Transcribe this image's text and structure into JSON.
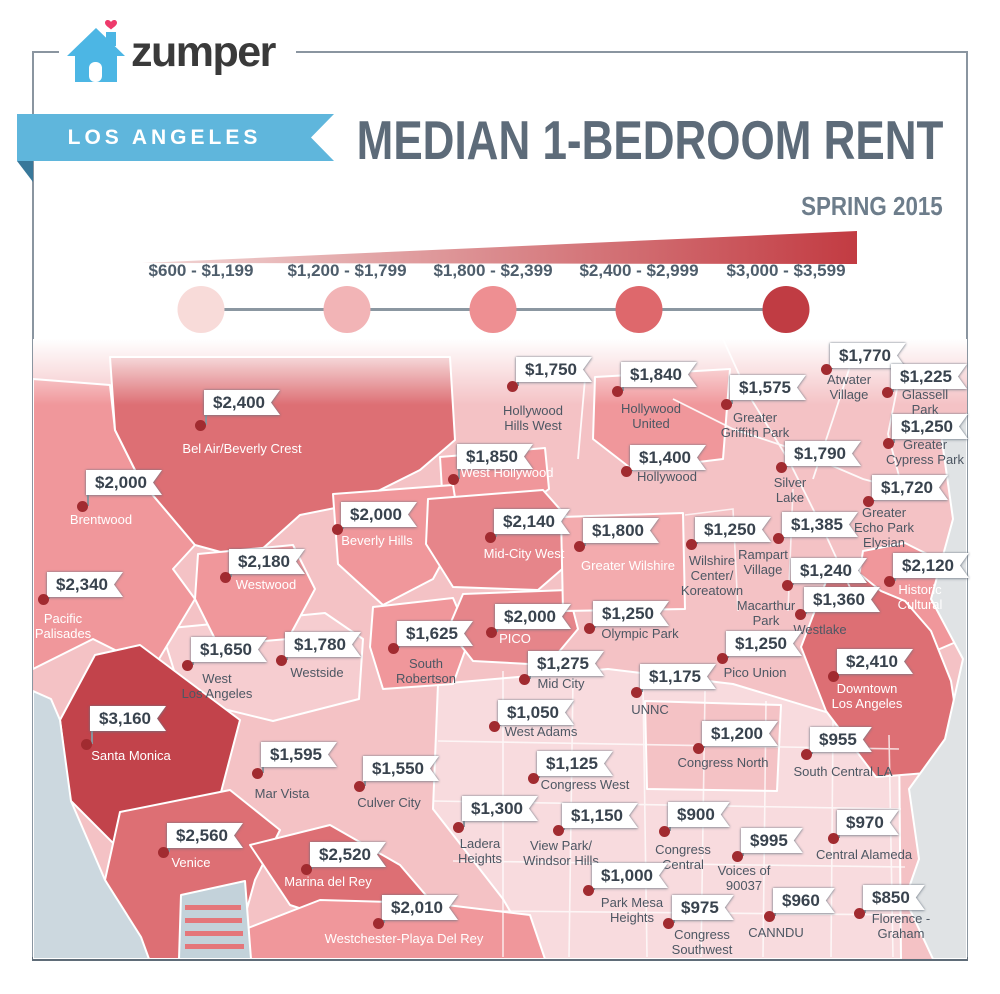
{
  "header": {
    "brand": "zumper",
    "ribbon": "LOS ANGELES",
    "title": "MEDIAN 1-BEDROOM RENT",
    "subtitle": "SPRING 2015"
  },
  "colors": {
    "ribbon_blue": "#5fb6dc",
    "ribbon_fold": "#38789a",
    "title": "#5d6b79",
    "subtitle": "#6d7d8b",
    "brand_text": "#3a3a3a",
    "house_blue": "#4cb6e4",
    "heart_pink": "#ee3a6b",
    "frame": "#8a95a0",
    "frame_bottom": "#5f6c78",
    "flag_text": "#39434e",
    "label_dark": "#4d5763",
    "label_light": "#ffffff",
    "dot": "#a12b30",
    "pole": "#8a939c",
    "legend_label": "#4e5d6b",
    "legend_line": "#8b97a1"
  },
  "legend": {
    "wedge": {
      "from": "#f2d8d7",
      "to": "#c23b42"
    },
    "ranges": [
      {
        "label": "$600 - $1,199",
        "color": "#f8dbd9",
        "x": 201
      },
      {
        "label": "$1,200 - $1,799",
        "color": "#f2b4b6",
        "x": 347
      },
      {
        "label": "$1,800 - $2,399",
        "color": "#ee8f92",
        "x": 493
      },
      {
        "label": "$2,400 - $2,999",
        "color": "#de686c",
        "x": 639
      },
      {
        "label": "$3,000 - $3,599",
        "color": "#c03c43",
        "x": 786
      }
    ]
  },
  "map": {
    "bucket_colors": {
      "b1": "#f8dbde",
      "b2": "#f4c2c5",
      "b2l": "#f6cdd0",
      "b3": "#f0979b",
      "b3l": "#f3abae",
      "b3d": "#e6858a",
      "b4": "#dd6f74",
      "b5": "#c2434b",
      "ocean": "#ccd8df",
      "gray": "#e0e3e5",
      "dock": "#c3d2da",
      "dockstripe": "#e4767a"
    },
    "neighborhoods": [
      {
        "p": "$1,750",
        "lines": [
          "Hollywood",
          "Hills West"
        ],
        "t": "dark",
        "d": [
          512,
          386
        ],
        "f": [
          516,
          357
        ],
        "l": [
          533,
          403
        ]
      },
      {
        "p": "$1,840",
        "lines": [
          "Hollywood",
          "United"
        ],
        "t": "dark",
        "d": [
          617,
          391
        ],
        "f": [
          621,
          362
        ],
        "l": [
          651,
          401
        ]
      },
      {
        "p": "$1,770",
        "lines": [
          "Atwater",
          "Village"
        ],
        "t": "dark",
        "d": [
          826,
          369
        ],
        "f": [
          830,
          343
        ],
        "l": [
          849,
          372
        ]
      },
      {
        "p": "$1,225",
        "lines": [
          "Glassell",
          "Park"
        ],
        "t": "dark",
        "d": [
          887,
          392
        ],
        "f": [
          891,
          364
        ],
        "l": [
          925,
          387
        ]
      },
      {
        "p": "$1,575",
        "lines": [
          "Greater",
          "Griffith Park"
        ],
        "t": "dark",
        "d": [
          726,
          404
        ],
        "f": [
          730,
          375
        ],
        "l": [
          755,
          410
        ]
      },
      {
        "p": "$1,250",
        "lines": [
          "Greater",
          "Cypress Park"
        ],
        "t": "dark",
        "d": [
          888,
          443
        ],
        "f": [
          892,
          414
        ],
        "l": [
          925,
          437
        ]
      },
      {
        "p": "$2,400",
        "lines": [
          "Bel Air/Beverly Crest"
        ],
        "t": "light",
        "d": [
          200,
          425
        ],
        "f": [
          204,
          390
        ],
        "l": [
          242,
          441
        ]
      },
      {
        "p": "$1,850",
        "lines": [
          "West Hollywood"
        ],
        "t": "light",
        "d": [
          453,
          479
        ],
        "f": [
          457,
          444
        ],
        "l": [
          507,
          465
        ]
      },
      {
        "p": "$1,400",
        "lines": [
          "Hollywood"
        ],
        "t": "dark",
        "d": [
          626,
          471
        ],
        "f": [
          630,
          445
        ],
        "l": [
          667,
          469
        ]
      },
      {
        "p": "$1,790",
        "lines": [
          "Silver",
          "Lake"
        ],
        "t": "dark",
        "d": [
          781,
          467
        ],
        "f": [
          785,
          441
        ],
        "l": [
          790,
          475
        ]
      },
      {
        "p": "$1,720",
        "lines": [
          "Greater",
          "Echo Park",
          "Elysian"
        ],
        "t": "dark",
        "d": [
          868,
          501
        ],
        "f": [
          872,
          475
        ],
        "l": [
          884,
          505
        ]
      },
      {
        "p": "$2,000",
        "lines": [
          "Brentwood"
        ],
        "t": "light",
        "d": [
          82,
          506
        ],
        "f": [
          86,
          470
        ],
        "l": [
          101,
          512
        ]
      },
      {
        "p": "$2,000",
        "lines": [
          "Beverly Hills"
        ],
        "t": "light",
        "d": [
          337,
          529
        ],
        "f": [
          341,
          502
        ],
        "l": [
          377,
          533
        ]
      },
      {
        "p": "$2,140",
        "lines": [
          "Mid-City West"
        ],
        "t": "light",
        "d": [
          490,
          537
        ],
        "f": [
          494,
          509
        ],
        "l": [
          524,
          546
        ]
      },
      {
        "p": "$1,800",
        "lines": [
          "Greater Wilshire"
        ],
        "t": "light",
        "d": [
          579,
          546
        ],
        "f": [
          583,
          518
        ],
        "l": [
          628,
          558
        ]
      },
      {
        "p": "$1,250",
        "lines": [
          "Wilshire",
          "Center/",
          "Koreatown"
        ],
        "t": "dark",
        "d": [
          691,
          544
        ],
        "f": [
          695,
          517
        ],
        "l": [
          712,
          553
        ]
      },
      {
        "p": "$1,385",
        "lines": [
          "Rampart",
          "Village"
        ],
        "t": "dark",
        "d": [
          778,
          538
        ],
        "f": [
          782,
          512
        ],
        "l": [
          763,
          547
        ]
      },
      {
        "p": "$2,180",
        "lines": [
          "Westwood"
        ],
        "t": "light",
        "d": [
          225,
          577
        ],
        "f": [
          229,
          549
        ],
        "l": [
          266,
          577
        ]
      },
      {
        "p": "$2,120",
        "lines": [
          "Historic",
          "Cultural"
        ],
        "t": "light",
        "d": [
          889,
          581
        ],
        "f": [
          893,
          553
        ],
        "l": [
          920,
          582
        ]
      },
      {
        "p": "$1,240",
        "lines": [
          "Macarthur",
          "Park"
        ],
        "t": "dark",
        "d": [
          787,
          585
        ],
        "f": [
          791,
          558
        ],
        "l": [
          766,
          598
        ]
      },
      {
        "p": "$2,340",
        "lines": [
          "Pacific",
          "Palisades"
        ],
        "t": "light",
        "d": [
          43,
          599
        ],
        "f": [
          47,
          572
        ],
        "l": [
          63,
          611
        ]
      },
      {
        "p": "$1,360",
        "lines": [
          "Westlake"
        ],
        "t": "dark",
        "d": [
          800,
          614
        ],
        "f": [
          804,
          587
        ],
        "l": [
          820,
          622
        ]
      },
      {
        "p": "$2,000",
        "lines": [
          "PICO"
        ],
        "t": "light",
        "d": [
          491,
          632
        ],
        "f": [
          495,
          604
        ],
        "l": [
          515,
          631
        ]
      },
      {
        "p": "$1,250",
        "lines": [
          "Olympic Park"
        ],
        "t": "dark",
        "d": [
          589,
          628
        ],
        "f": [
          593,
          601
        ],
        "l": [
          640,
          626
        ]
      },
      {
        "p": "$1,625",
        "lines": [
          "South",
          "Robertson"
        ],
        "t": "dark",
        "d": [
          393,
          648
        ],
        "f": [
          397,
          621
        ],
        "l": [
          426,
          656
        ]
      },
      {
        "p": "$1,780",
        "lines": [
          "Westside"
        ],
        "t": "dark",
        "d": [
          281,
          660
        ],
        "f": [
          285,
          632
        ],
        "l": [
          317,
          665
        ]
      },
      {
        "p": "$1,650",
        "lines": [
          "West",
          "Los Angeles"
        ],
        "t": "dark",
        "d": [
          187,
          665
        ],
        "f": [
          191,
          637
        ],
        "l": [
          217,
          671
        ]
      },
      {
        "p": "$1,250",
        "lines": [
          "Pico Union"
        ],
        "t": "dark",
        "d": [
          722,
          658
        ],
        "f": [
          726,
          631
        ],
        "l": [
          755,
          665
        ]
      },
      {
        "p": "$2,410",
        "lines": [
          "Downtown",
          "Los Angeles"
        ],
        "t": "light",
        "d": [
          833,
          676
        ],
        "f": [
          837,
          649
        ],
        "l": [
          867,
          681
        ]
      },
      {
        "p": "$1,275",
        "lines": [
          "Mid City"
        ],
        "t": "dark",
        "d": [
          524,
          679
        ],
        "f": [
          528,
          651
        ],
        "l": [
          561,
          676
        ]
      },
      {
        "p": "$1,175",
        "lines": [
          "UNNC"
        ],
        "t": "dark",
        "d": [
          636,
          692
        ],
        "f": [
          640,
          664
        ],
        "l": [
          650,
          702
        ]
      },
      {
        "p": "$3,160",
        "lines": [
          "Santa Monica"
        ],
        "t": "light",
        "d": [
          86,
          744
        ],
        "f": [
          90,
          706
        ],
        "l": [
          131,
          748
        ]
      },
      {
        "p": "$1,050",
        "lines": [
          "West Adams"
        ],
        "t": "dark",
        "d": [
          494,
          726
        ],
        "f": [
          498,
          700
        ],
        "l": [
          541,
          724
        ]
      },
      {
        "p": "$1,200",
        "lines": [
          "Congress North"
        ],
        "t": "dark",
        "d": [
          698,
          748
        ],
        "f": [
          702,
          721
        ],
        "l": [
          723,
          755
        ]
      },
      {
        "p": "$955",
        "lines": [
          "South Central LA"
        ],
        "t": "dark",
        "d": [
          806,
          754
        ],
        "f": [
          810,
          727
        ],
        "l": [
          843,
          764
        ]
      },
      {
        "p": "$1,595",
        "lines": [
          "Mar Vista"
        ],
        "t": "dark",
        "d": [
          257,
          773
        ],
        "f": [
          261,
          742
        ],
        "l": [
          282,
          786
        ]
      },
      {
        "p": "$1,125",
        "lines": [
          "Congress West"
        ],
        "t": "dark",
        "d": [
          533,
          778
        ],
        "f": [
          537,
          751
        ],
        "l": [
          585,
          777
        ]
      },
      {
        "p": "$1,550",
        "lines": [
          "Culver City"
        ],
        "t": "dark",
        "d": [
          359,
          786
        ],
        "f": [
          363,
          756
        ],
        "l": [
          389,
          795
        ]
      },
      {
        "p": "$1,300",
        "lines": [
          "Ladera",
          "Heights"
        ],
        "t": "dark",
        "d": [
          458,
          827
        ],
        "f": [
          462,
          796
        ],
        "l": [
          480,
          836
        ]
      },
      {
        "p": "$1,150",
        "lines": [
          "View Park/",
          "Windsor Hills"
        ],
        "t": "dark",
        "d": [
          558,
          830
        ],
        "f": [
          562,
          803
        ],
        "l": [
          561,
          838
        ]
      },
      {
        "p": "$900",
        "lines": [
          "Congress",
          "Central"
        ],
        "t": "dark",
        "d": [
          664,
          831
        ],
        "f": [
          668,
          802
        ],
        "l": [
          683,
          842
        ]
      },
      {
        "p": "$970",
        "lines": [
          "Central Alameda"
        ],
        "t": "dark",
        "d": [
          833,
          838
        ],
        "f": [
          837,
          810
        ],
        "l": [
          864,
          847
        ]
      },
      {
        "p": "$2,560",
        "lines": [
          "Venice"
        ],
        "t": "light",
        "d": [
          163,
          852
        ],
        "f": [
          167,
          823
        ],
        "l": [
          191,
          855
        ]
      },
      {
        "p": "$995",
        "lines": [
          "Voices of",
          "90037"
        ],
        "t": "dark",
        "d": [
          737,
          856
        ],
        "f": [
          741,
          828
        ],
        "l": [
          744,
          863
        ]
      },
      {
        "p": "$2,520",
        "lines": [
          "Marina del Rey"
        ],
        "t": "light",
        "d": [
          306,
          869
        ],
        "f": [
          310,
          842
        ],
        "l": [
          328,
          874
        ]
      },
      {
        "p": "$1,000",
        "lines": [
          "Park Mesa",
          "Heights"
        ],
        "t": "dark",
        "d": [
          588,
          890
        ],
        "f": [
          592,
          863
        ],
        "l": [
          632,
          895
        ]
      },
      {
        "p": "$960",
        "lines": [
          "CANNDU"
        ],
        "t": "dark",
        "d": [
          769,
          916
        ],
        "f": [
          773,
          888
        ],
        "l": [
          776,
          925
        ]
      },
      {
        "p": "$850",
        "lines": [
          "Florence -",
          "Graham"
        ],
        "t": "dark",
        "d": [
          859,
          913
        ],
        "f": [
          863,
          885
        ],
        "l": [
          901,
          911
        ]
      },
      {
        "p": "$2,010",
        "lines": [
          "Westchester-Playa Del Rey"
        ],
        "t": "light",
        "d": [
          378,
          923
        ],
        "f": [
          382,
          895
        ],
        "l": [
          404,
          931
        ]
      },
      {
        "p": "$975",
        "lines": [
          "Congress",
          "Southwest"
        ],
        "t": "dark",
        "d": [
          668,
          923
        ],
        "f": [
          672,
          895
        ],
        "l": [
          702,
          927
        ]
      }
    ]
  }
}
